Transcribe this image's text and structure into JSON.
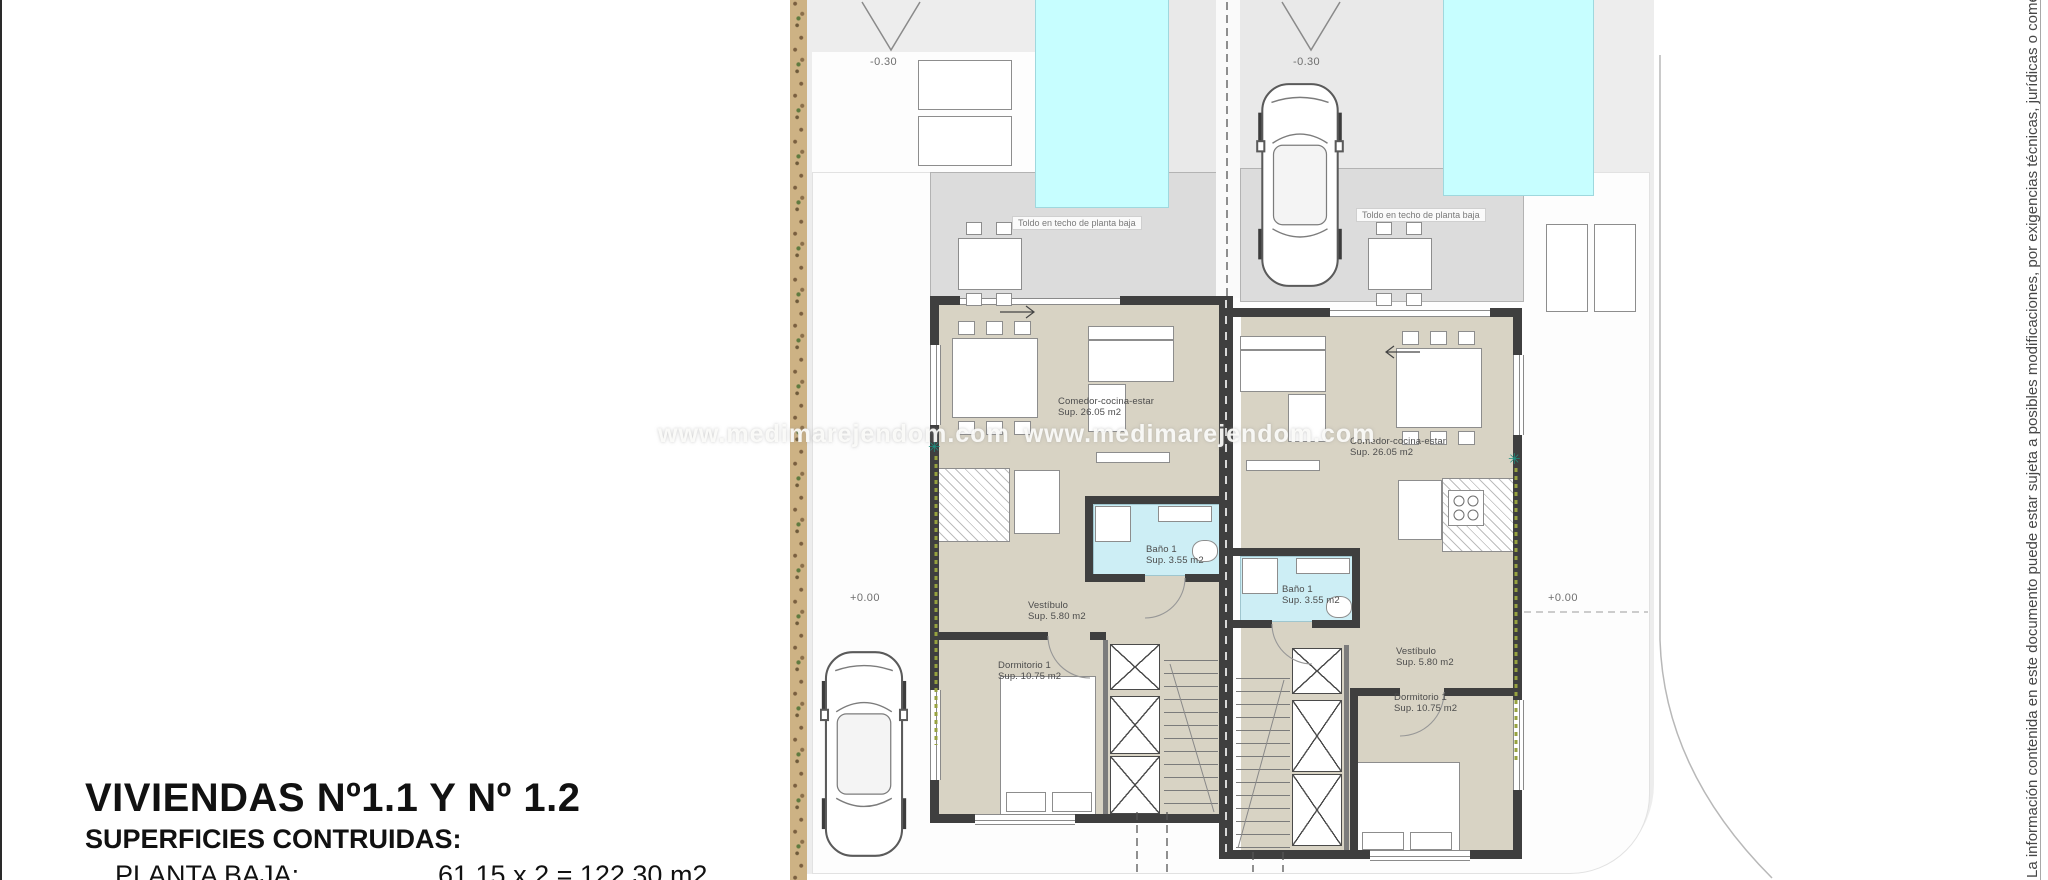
{
  "title_block": {
    "title": "VIVIENDAS Nº1.1 Y Nº 1.2",
    "subtitle": "SUPERFICIES CONTRUIDAS:",
    "rows": [
      {
        "label": "PLANTA BAJA:",
        "value": "61.15 x 2 = 122.30 m2"
      }
    ]
  },
  "watermark": {
    "text": "www.medimarejendom.com"
  },
  "disclaimer": {
    "text": "La información contenida en este documento puede estar sujeta a posibles modificaciones, por exigencias técnicas, jurídicas o comerciales. El mobilia"
  },
  "site": {
    "levels": {
      "street": "-0.30",
      "ground": "+0.00"
    }
  },
  "units": [
    {
      "banner": "Toldo en techo de planta baja",
      "rooms": {
        "living": {
          "name": "Comedor-cocina-estar",
          "area": "Sup. 26.05 m2"
        },
        "bath": {
          "name": "Baño 1",
          "area": "Sup. 3.55 m2"
        },
        "hall": {
          "name": "Vestíbulo",
          "area": "Sup. 5.80 m2"
        },
        "bedroom": {
          "name": "Dormitorio 1",
          "area": "Sup. 10.75 m2"
        }
      }
    },
    {
      "banner": "Toldo en techo de planta baja",
      "rooms": {
        "living": {
          "name": "Comedor-cocina-estar",
          "area": "Sup. 26.05 m2"
        },
        "bath": {
          "name": "Baño 1",
          "area": "Sup. 3.55 m2"
        },
        "hall": {
          "name": "Vestíbulo",
          "area": "Sup. 5.80 m2"
        },
        "bedroom": {
          "name": "Dormitorio 1",
          "area": "Sup. 10.75 m2"
        }
      }
    }
  ],
  "colors": {
    "pool": "#c7feff",
    "wall": "#3f3f3f",
    "floor": "#d8d3c4",
    "bath_floor": "#cdeef5",
    "site": "#ededed",
    "terrace": "#dcdcdc"
  }
}
